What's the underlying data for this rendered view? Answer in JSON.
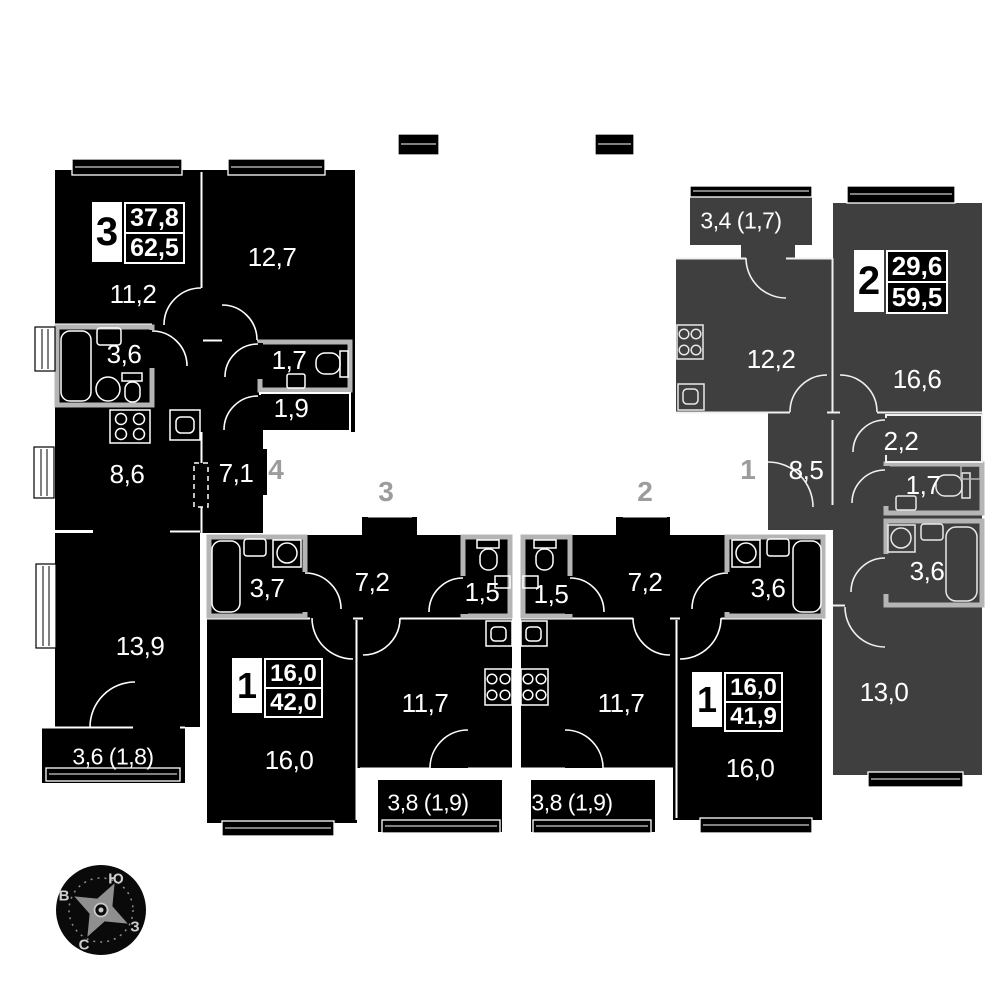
{
  "plan": {
    "apartments": [
      {
        "key": "apt-3room",
        "badge": "3",
        "upper": "37,8",
        "lower": "62,5",
        "rooms": [
          {
            "label": "11,2"
          },
          {
            "label": "12,7"
          },
          {
            "label": "3,6"
          },
          {
            "label": "1,7"
          },
          {
            "label": "1,9"
          },
          {
            "label": "8,6"
          },
          {
            "label": "7,1"
          },
          {
            "label": "13,9"
          },
          {
            "label": "3,6 (1,8)"
          }
        ]
      },
      {
        "key": "apt-1room-left",
        "badge": "1",
        "upper": "16,0",
        "lower": "42,0",
        "rooms": [
          {
            "label": "3,7"
          },
          {
            "label": "7,2"
          },
          {
            "label": "1,5"
          },
          {
            "label": "16,0"
          },
          {
            "label": "11,7"
          },
          {
            "label": "3,8 (1,9)"
          }
        ]
      },
      {
        "key": "apt-1room-right",
        "badge": "1",
        "upper": "16,0",
        "lower": "41,9",
        "rooms": [
          {
            "label": "1,5"
          },
          {
            "label": "7,2"
          },
          {
            "label": "3,6"
          },
          {
            "label": "11,7"
          },
          {
            "label": "16,0"
          },
          {
            "label": "3,8 (1,9)"
          }
        ]
      },
      {
        "key": "apt-2room",
        "badge": "2",
        "upper": "29,6",
        "lower": "59,5",
        "rooms": [
          {
            "label": "3,4 (1,7)"
          },
          {
            "label": "12,2"
          },
          {
            "label": "16,6"
          },
          {
            "label": "8,5"
          },
          {
            "label": "2,2"
          },
          {
            "label": "1,7"
          },
          {
            "label": "3,6"
          },
          {
            "label": "13,0"
          }
        ]
      }
    ],
    "entrances": [
      {
        "label": "4"
      },
      {
        "label": "3"
      },
      {
        "label": "2"
      },
      {
        "label": "1"
      }
    ],
    "compass": {
      "south": "Ю",
      "east": "В",
      "north": "С",
      "west": "З"
    },
    "colors": {
      "black_apartment": "#000000",
      "grey_apartment": "#3f3f3f",
      "wet_zone_wall": "#b5b5b5",
      "entrance_number": "#9c9c9c"
    }
  }
}
